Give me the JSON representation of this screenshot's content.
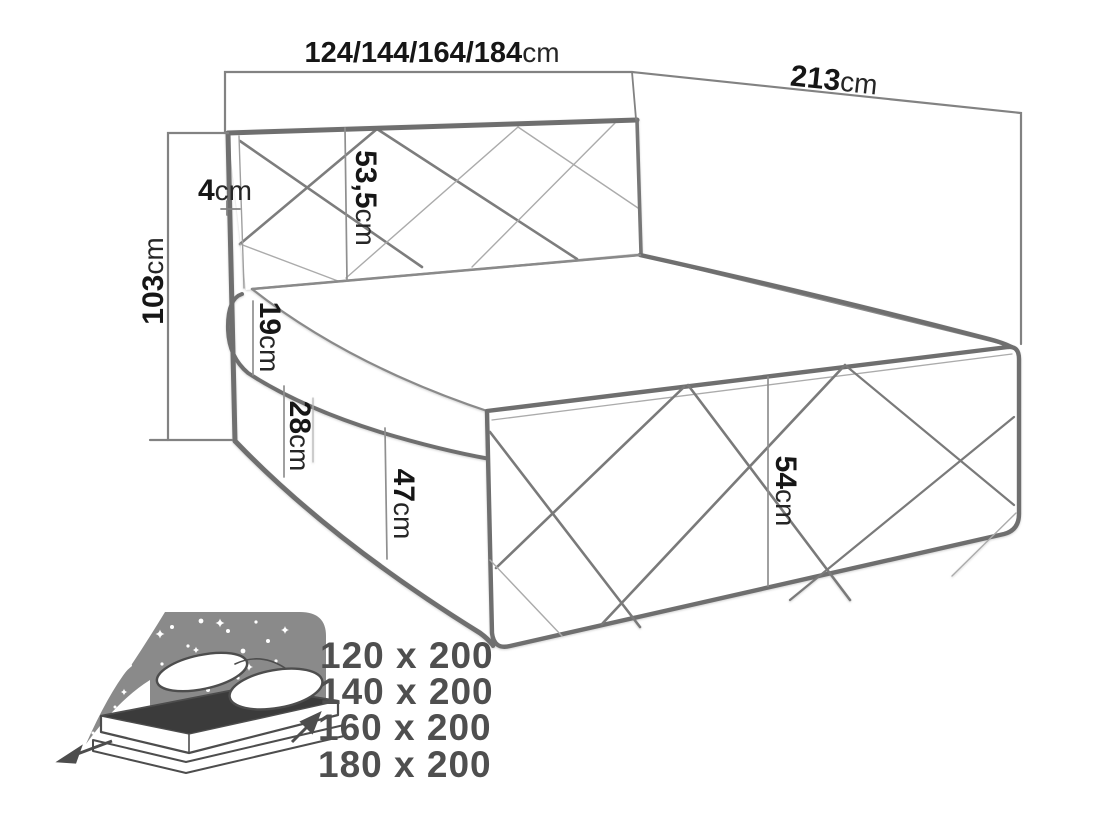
{
  "diagram": {
    "dim_width": {
      "value": "124/144/164/184",
      "unit": "cm"
    },
    "dim_depth": {
      "value": "213",
      "unit": "cm"
    },
    "dim_height_total": {
      "value": "103",
      "unit": "cm"
    },
    "dim_headboard_frame": {
      "value": "4",
      "unit": "cm"
    },
    "dim_headboard_panel": {
      "value": "53,5",
      "unit": "cm"
    },
    "dim_mattress": {
      "value": "19",
      "unit": "cm"
    },
    "dim_base": {
      "value": "28",
      "unit": "cm"
    },
    "dim_side": {
      "value": "47",
      "unit": "cm"
    },
    "dim_footboard": {
      "value": "54",
      "unit": "cm"
    }
  },
  "size_options": {
    "items": [
      {
        "label": "120 x 200"
      },
      {
        "label": "140 x 200"
      },
      {
        "label": "160 x 200"
      },
      {
        "label": "180 x 200"
      }
    ]
  },
  "colors": {
    "line_dark": "#6f6f6f",
    "line_mid": "#858585",
    "line_light": "#ababab",
    "dim_line": "#828282",
    "label_text": "#161616",
    "size_text": "#4f4f4f",
    "icon_gray": "#8a8a8a",
    "icon_dark": "#3b3b3b",
    "background": "#ffffff"
  }
}
